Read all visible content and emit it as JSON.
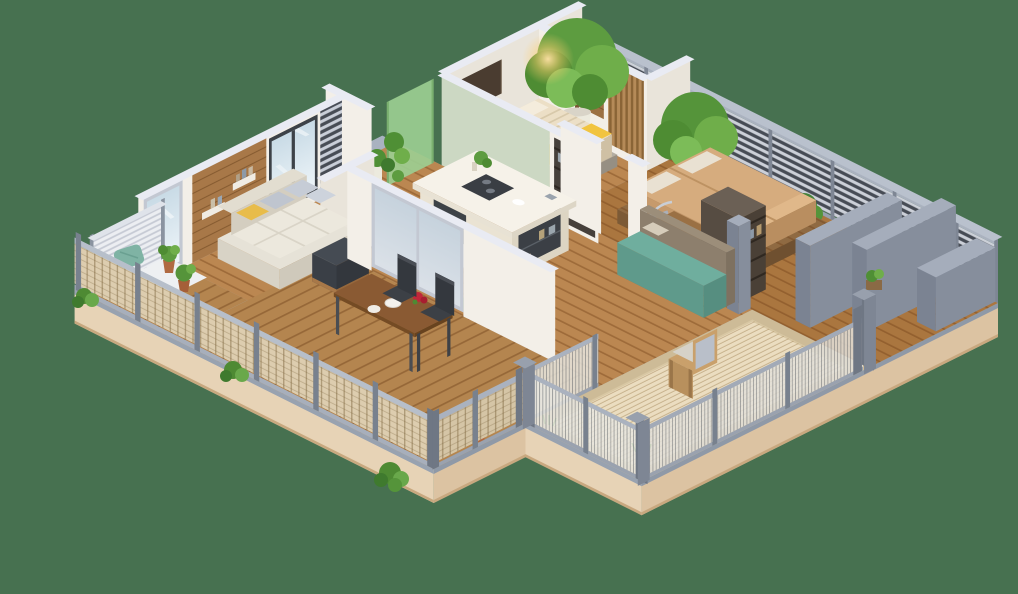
{
  "background": "#477150",
  "palette": {
    "background": "#477150",
    "plinth_top": "#a9b2c0",
    "plinth_side": "#dcc3a2",
    "plinth_side_light": "#e7d3b6",
    "plinth_lip": "#8f99a7",
    "plinth_base_edge": "#c8a87f",
    "floor_interior": "#bb8751",
    "floor_bedroom2": "#aa763f",
    "floor_deck": "#b4854f",
    "floor_rug_base": "#cdbb97",
    "rug": "#ebddc0",
    "wall_white": "#f3efe8",
    "wall_white_dark": "#e9e4da",
    "wall_cap": "#e9ebf3",
    "wall_sage": "#ccd8c3",
    "wall_wood": "#a87848",
    "railing_frame": "#9aa2af",
    "railing_slat_bg": "#ccd0d8",
    "post_gray": "#78818e",
    "fence_woven": "#ddcdaf",
    "fence_wire": "#e8e6df",
    "parapet": "#8b93a2",
    "parapet_top": "#a5adbb",
    "sofa_cream": "#e6e2d7",
    "cushion_gray": "#c6ccd6",
    "pillow_yellow": "#e8bc4a",
    "ottoman_dark": "#3a3f46",
    "island_top": "#f6f2e9",
    "island_base": "#eae3d3",
    "appliance_dark": "#3d4247",
    "bed_tan": "#d6ac7e",
    "bed_cream": "#ecdfc6",
    "throw_yellow": "#f1c440",
    "bed_base_concrete": "#b4aea2",
    "bed_platform_wood": "#8f6a42",
    "teal": "#6fae9e",
    "teal_dark": "#5f9a8b",
    "bench_back_brown": "#8d7f6d",
    "table_walnut": "#8a5a33",
    "chair_dark": "#3c4046",
    "desk_wood": "#9a7044",
    "armchair_wood": "#c9a06b",
    "green_dark": "#3f7a2e",
    "green_mid": "#5d9c40",
    "green_light": "#7cbc58",
    "trunk": "#7a5634",
    "pot_white": "#eceade",
    "pot_terracotta": "#b06a42",
    "glass_green": "#9ccf92",
    "glass_blue": "#d7e4ea",
    "glow": "#ffd98a",
    "flower_red": "#c0273a"
  },
  "scene": {
    "type": "isometric-3d-apartment-floor-plan",
    "platform": {
      "shape": "irregular-diamond",
      "plinth": "beige",
      "walkway_border": "gray"
    },
    "rooms": [
      {
        "id": "left-balcony",
        "features": [
          "white-slat-screen",
          "teal-cushion",
          "terracotta-potted-plants",
          "white-bench",
          "grass-planter",
          "wood-deck"
        ]
      },
      {
        "id": "living-room",
        "features": [
          "corner-sofa-cream",
          "gray-pillows",
          "yellow-pillows",
          "dark-ottoman",
          "wood-accent-wall",
          "wall-shelves",
          "large-windows"
        ]
      },
      {
        "id": "kitchen-hall",
        "features": [
          "kitchen-island",
          "cooktop",
          "white-chair",
          "small-dining-table",
          "two-dark-chairs",
          "dark-wardrobe-cabinet"
        ]
      },
      {
        "id": "entry-court",
        "features": [
          "green-glass-panel",
          "climbing-plants",
          "white-pot-tree",
          "hedge-planter"
        ]
      },
      {
        "id": "bedroom-small",
        "features": [
          "bed-cream-duvet",
          "yellow-throw",
          "concrete-bed-base",
          "wood-headboard-panel",
          "wood-slat-wall",
          "wall-sconce-glow",
          "sage-accent-wall",
          "dark-wall-panel"
        ]
      },
      {
        "id": "bedroom-large",
        "features": [
          "double-bed-tan",
          "wood-slat-platform",
          "chrome-lounge-chair",
          "desk",
          "white-desk-chair",
          "dark-closet",
          "large-potted-tree",
          "wood-stool"
        ]
      },
      {
        "id": "wood-terrace",
        "features": [
          "walnut-dining-table",
          "two-dark-chairs",
          "white-plates",
          "red-flowers",
          "woven-fence-panels",
          "hedge-planters",
          "plank-deck"
        ]
      },
      {
        "id": "rug-terrace",
        "features": [
          "woven-beige-rug",
          "wood-armchair-gray-cushion",
          "wire-fence-panels",
          "grass-tufts",
          "teal-bench",
          "brown-bench-back",
          "beige-pillow"
        ]
      },
      {
        "id": "east-walkway",
        "features": [
          "gray-parapet-walls",
          "planter-niche",
          "green-shrub",
          "horizontal-slat-railing",
          "big-corner-posts"
        ]
      },
      {
        "id": "north-strip",
        "features": [
          "two-large-potted-trees",
          "horizontal-slat-railing",
          "wood-floor"
        ]
      }
    ]
  }
}
